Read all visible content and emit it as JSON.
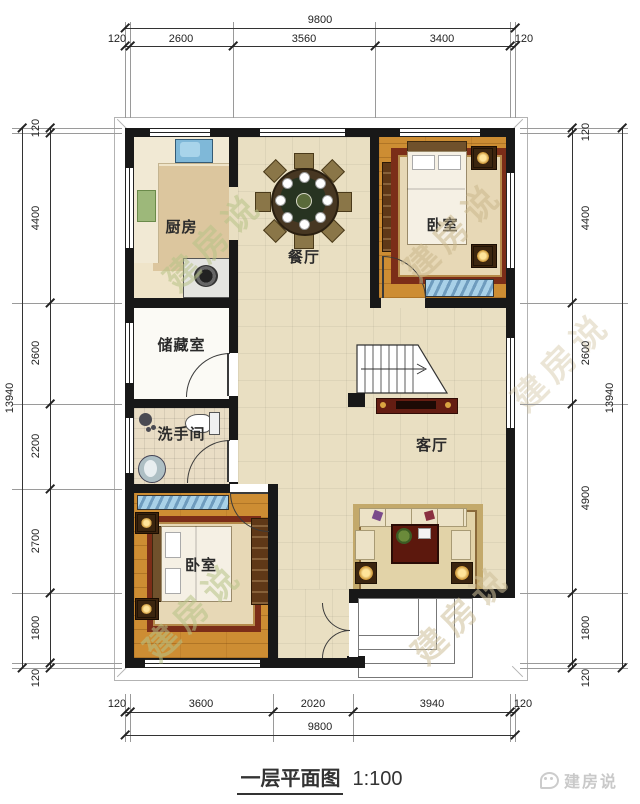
{
  "title": {
    "main": "一层平面图",
    "scale": "1:100"
  },
  "logo": {
    "text": "建房说"
  },
  "watermark": {
    "text": "建房说"
  },
  "rooms": {
    "kitchen": "厨房",
    "dining": "餐厅",
    "bedroom_top": "卧室",
    "storage": "储藏室",
    "bathroom": "洗手间",
    "living": "客厅",
    "bedroom_bottom": "卧室"
  },
  "dimensions": {
    "top": {
      "total": "9800",
      "segments": [
        "120",
        "2600",
        "3560",
        "3400",
        "120"
      ]
    },
    "bottom": {
      "total": "9800",
      "segments": [
        "120",
        "3600",
        "2020",
        "3940",
        "120"
      ]
    },
    "left": {
      "total": "13940",
      "segments": [
        "120",
        "4400",
        "2600",
        "2200",
        "2700",
        "1800",
        "120"
      ]
    },
    "right": {
      "total": "13940",
      "segments": [
        "120",
        "4400",
        "2600",
        "4900",
        "1800",
        "120"
      ]
    }
  },
  "colors": {
    "wall": "#181818",
    "floor_wood": "#cd8d33",
    "floor_cream": "#e9dfc2",
    "window_blue": "#6f9cbe",
    "accent_red": "#641d12"
  }
}
